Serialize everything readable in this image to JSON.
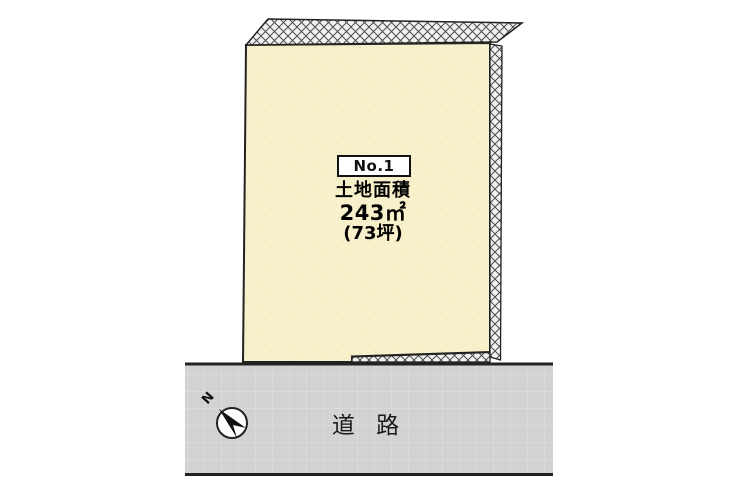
{
  "plot": {
    "number": "No.1",
    "area_title": "土地面積",
    "area_sqm": "243㎡",
    "area_tsubo": "(73坪)"
  },
  "road": {
    "label": "道 路"
  },
  "compass": {
    "north_label": "N"
  },
  "colors": {
    "land_fill": "#f7f0cb",
    "land_speckle": "#e9dca6",
    "road_fill": "#d2d2d2",
    "road_grid_line": "#dfdfdf",
    "outline": "#222222",
    "hatch_background": "#f1f1ef",
    "hatch_line": "#4c4c4c",
    "needle_fill": "#111111"
  }
}
